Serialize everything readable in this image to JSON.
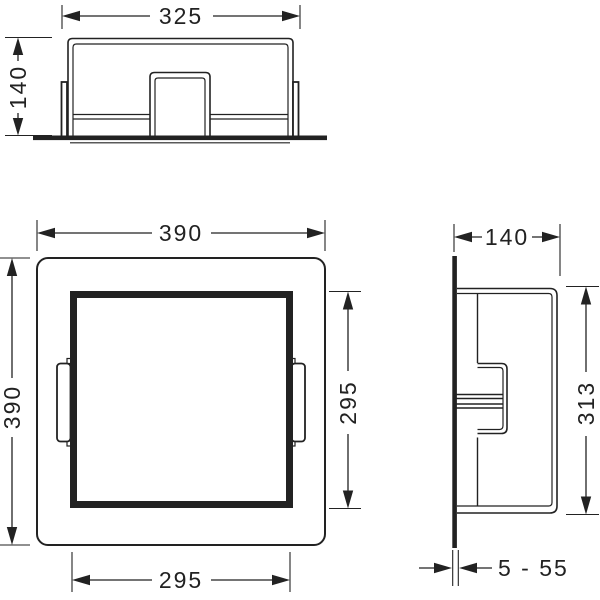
{
  "views": {
    "top": {
      "width_dim": "325",
      "depth_dim": "140"
    },
    "front": {
      "outer_width_dim": "390",
      "outer_height_dim": "390",
      "inner_height_dim": "295",
      "inner_width_dim": "295"
    },
    "side": {
      "depth_dim": "140",
      "height_dim": "313",
      "tile_range_dim": "5 - 55"
    }
  },
  "colors": {
    "line": "#222222",
    "background": "#ffffff"
  }
}
